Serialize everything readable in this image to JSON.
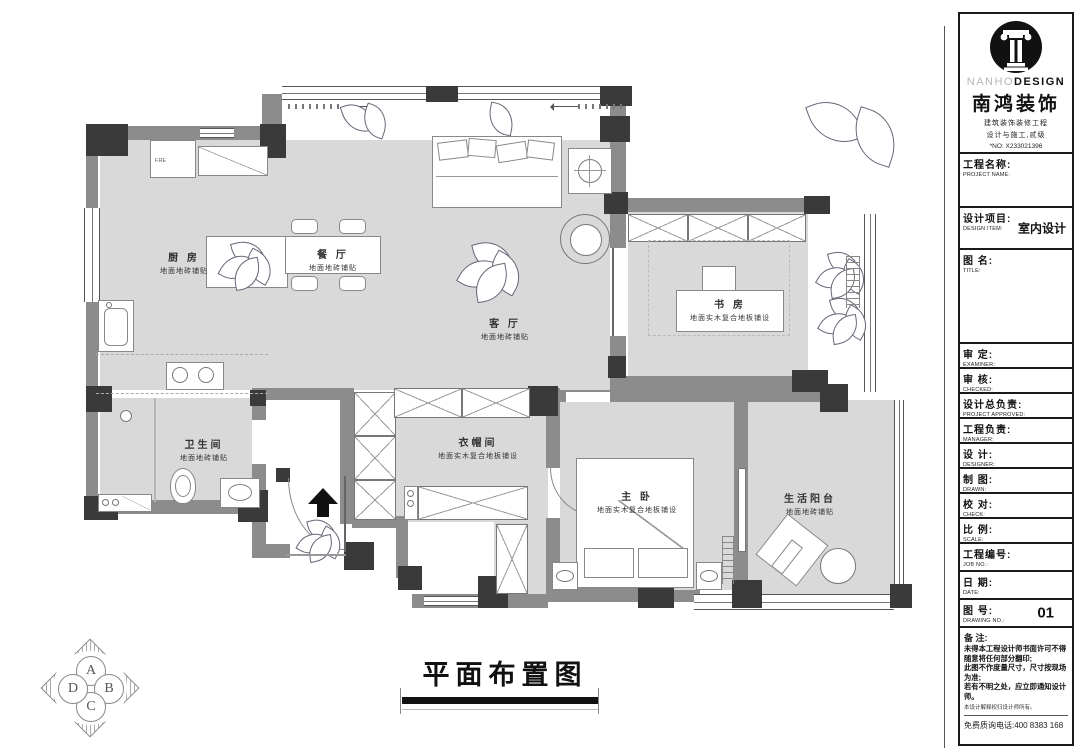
{
  "plan": {
    "drawing_title": "平面布置图",
    "compass": [
      "A",
      "B",
      "C",
      "D"
    ],
    "appliance_label": "F.RE",
    "rooms": [
      {
        "name": "厨 房",
        "sub": "地面地砖铺贴"
      },
      {
        "name": "餐 厅",
        "sub": "地面地砖铺贴"
      },
      {
        "name": "客 厅",
        "sub": "地面地砖铺贴"
      },
      {
        "name": "书 房",
        "sub": "地面实木复合地板铺设"
      },
      {
        "name": "卫生间",
        "sub": "地面地砖铺贴"
      },
      {
        "name": "衣帽间",
        "sub": "地面实木复合地板铺设"
      },
      {
        "name": "主 卧",
        "sub": "地面实木复合地板铺设"
      },
      {
        "name": "生活阳台",
        "sub": "地面地砖铺贴"
      }
    ]
  },
  "title_block": {
    "logo": {
      "en_light": "NANHO",
      "en_bold": "DESIGN",
      "cn": "南鸿装饰",
      "sub1": "建筑装饰装修工程",
      "sub2": "设计与施工,贰级",
      "no": "*NO: X233021396"
    },
    "fields": [
      {
        "cn": "工程名称:",
        "en": "PROJECT NAME:",
        "value": ""
      },
      {
        "cn": "设计项目:",
        "en": "DESIGN ITEM:",
        "value": "室内设计"
      },
      {
        "cn": "图  名:",
        "en": "TITLE:",
        "value": ""
      },
      {
        "cn": "审  定:",
        "en": "EXAMINER:",
        "value": ""
      },
      {
        "cn": "审  核:",
        "en": "CHECKED:",
        "value": ""
      },
      {
        "cn": "设计总负责:",
        "en": "PROJECT APPROVED:",
        "value": ""
      },
      {
        "cn": "工程负责:",
        "en": "MANAGER:",
        "value": ""
      },
      {
        "cn": "设  计:",
        "en": "DESIGNER:",
        "value": ""
      },
      {
        "cn": "制  图:",
        "en": "DRAWN:",
        "value": ""
      },
      {
        "cn": "校  对:",
        "en": "CHECK:",
        "value": ""
      },
      {
        "cn": "比  例:",
        "en": "SCALE:",
        "value": ""
      },
      {
        "cn": "工程编号:",
        "en": "JOB NO.:",
        "value": ""
      },
      {
        "cn": "日  期:",
        "en": "DATE:",
        "value": ""
      },
      {
        "cn": "图  号:",
        "en": "DRAWING NO.:",
        "value": "01"
      }
    ],
    "notes": {
      "title": "备 注:",
      "lines": [
        "未得本工程设计师书面许可不得",
        "随意将任何部分翻印;",
        "此图不作度量尺寸，尺寸按现场",
        "为准;",
        "若有不明之处，应立即通知设计",
        "师。"
      ],
      "fine_print": "本设计解释权归设计师所有。",
      "phone": "免费质询电话:400 8383 168"
    }
  }
}
